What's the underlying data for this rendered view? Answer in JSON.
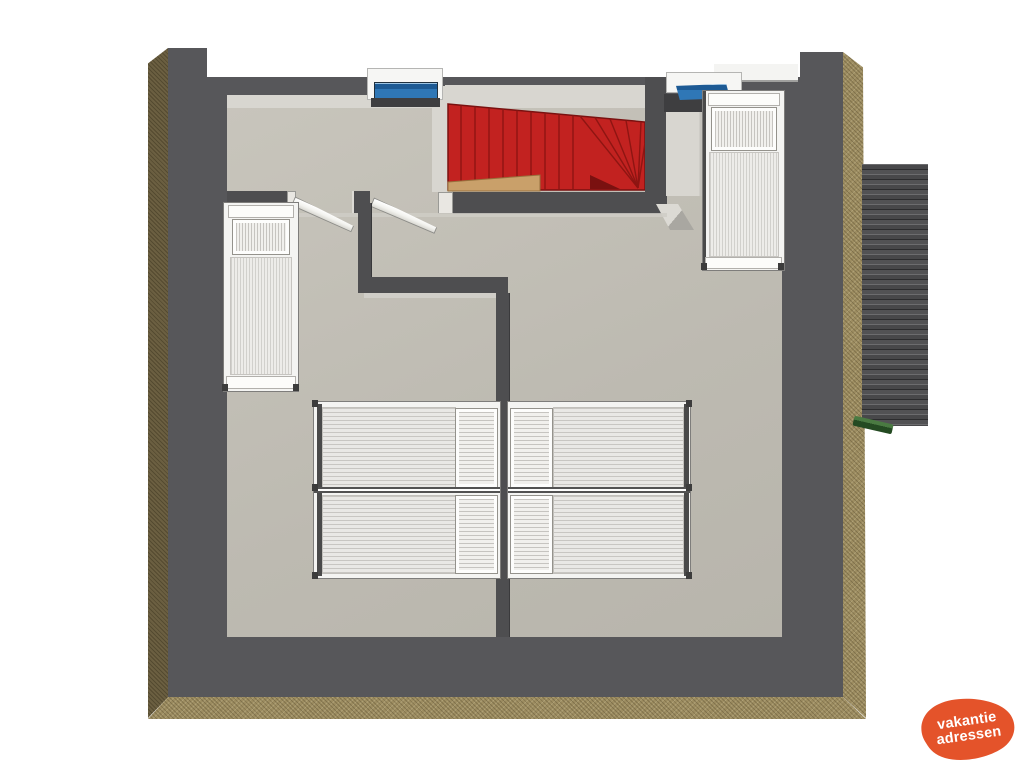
{
  "canvas": {
    "width": 1024,
    "height": 768,
    "background": "#ffffff"
  },
  "watermark": {
    "line1": "vakantie",
    "line2": "adressen",
    "shape": "orange-blob",
    "blob_color": "#e4532a",
    "text_color": "#ffffff"
  },
  "palette": {
    "floor": "#bdbab1",
    "floor_highlight_band": "#d8d6d0",
    "outer_wall": "#57575a",
    "inner_wall": "#4e4e50",
    "cut_edge_left": "#6b5f41",
    "cut_edge_bottom_right": "#9d8d61",
    "stairs_red": "#c22220",
    "stairs_dark_red": "#7a1110",
    "stairs_wood": "#c9a06a",
    "skylight_glass_blue": "#2f77b6",
    "roof_tiles": "#4a4a4c",
    "gutter_green": "#31602f",
    "bed_white": "#f4f4f2",
    "door_white": "#fafaf8"
  },
  "scene": {
    "type": "3d-floor-plan-top-view",
    "objects": [
      "red-staircase-with-winders",
      "skylight-left",
      "skylight-right",
      "single-bed-left-room",
      "single-bed-right-room",
      "double-bed-pair-bottom-left",
      "double-bed-pair-bottom-right",
      "open-door-left-room",
      "open-door-right-room",
      "roof-tile-section-right",
      "gutter-green"
    ],
    "bed_count": 6,
    "skylight_count": 2,
    "door_count": 2
  }
}
